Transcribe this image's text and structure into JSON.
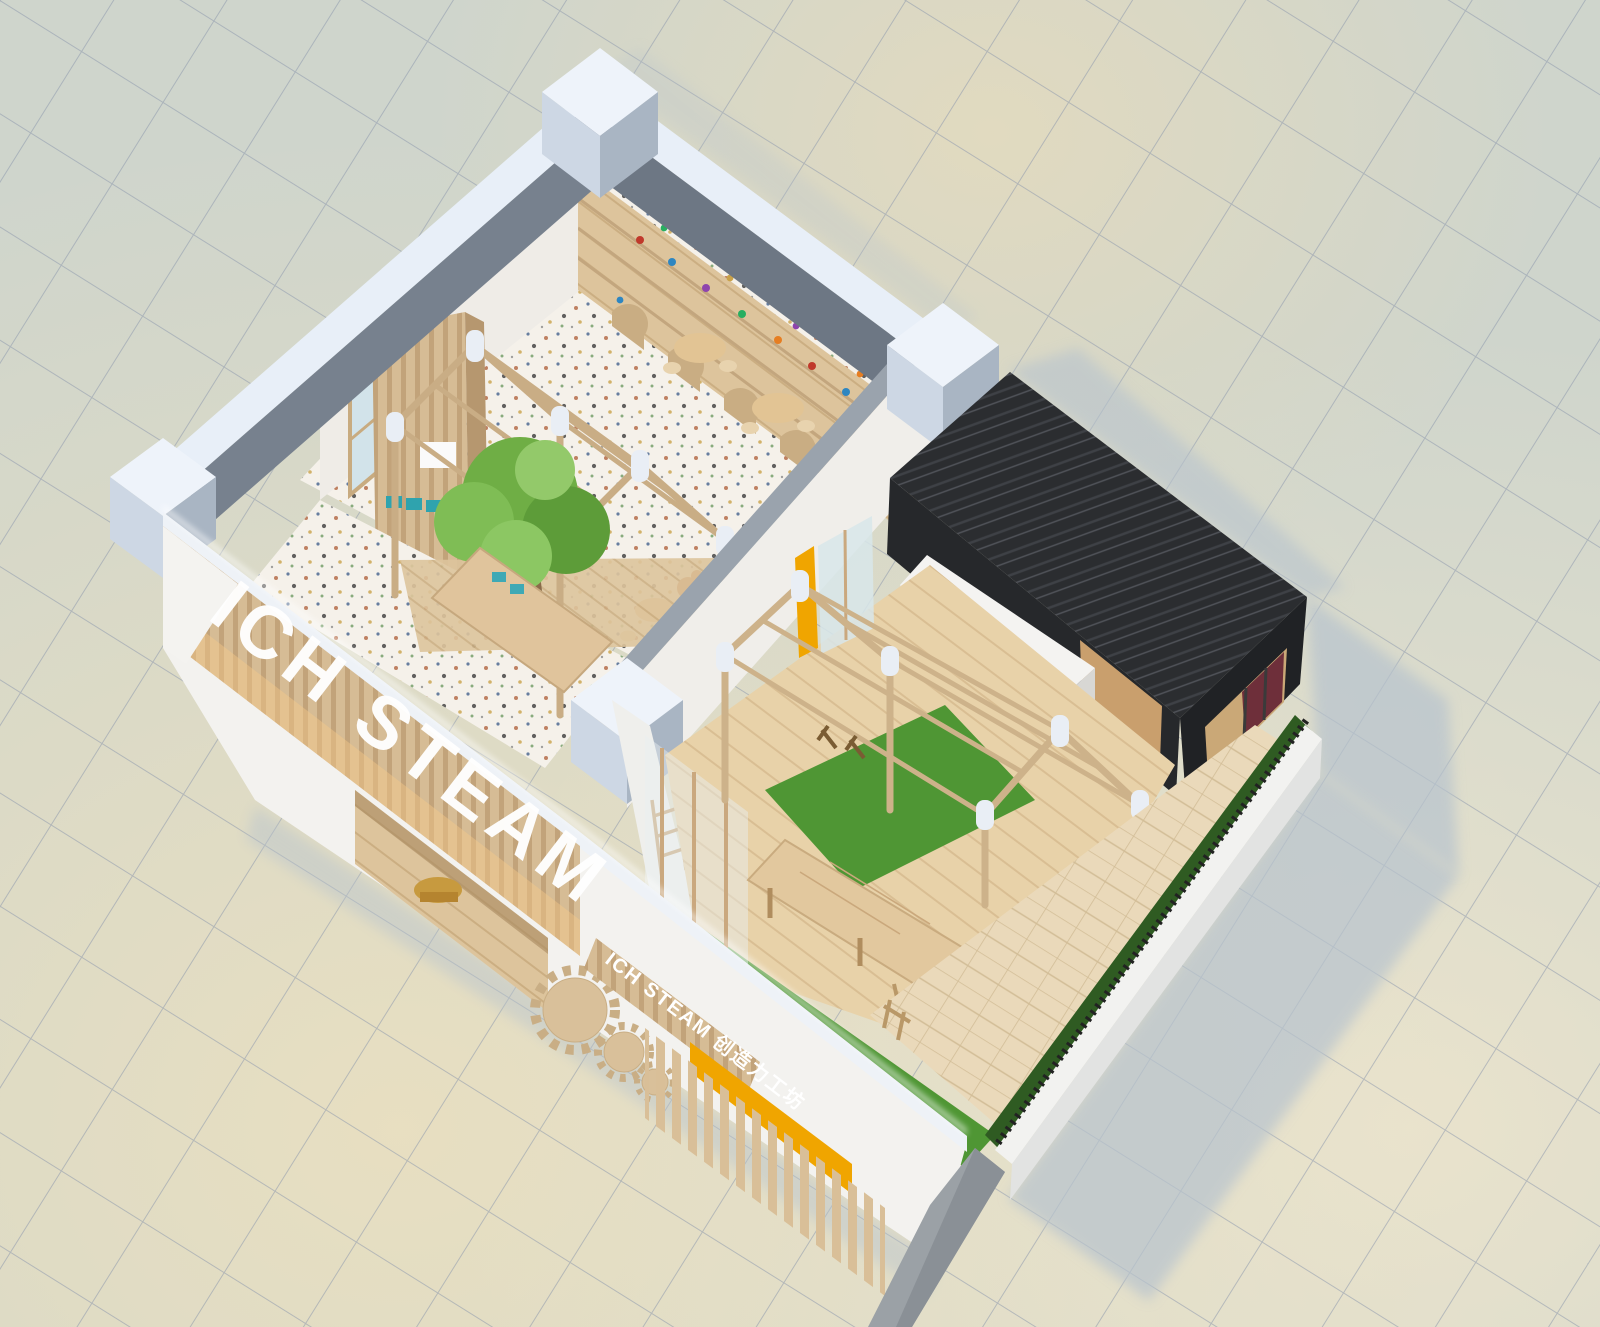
{
  "scene": {
    "kind": "axonometric-architectural-render",
    "subject": "children STEAM education center interior cutaway model",
    "view": "isometric top-down cutaway"
  },
  "branding": {
    "facade_letters": "ICH STEAM",
    "wall_sign_text": "ICH STEAM 创造力工坊",
    "logo_icon": "wood-gear-emblem"
  },
  "palette": {
    "ground_tile": "#cfd5cc",
    "ground_tile_warm": "#ecdfc0",
    "grid_line": "#8d99ad",
    "cast_shadow": "#b7c3ce",
    "wall_light": "#e8eff8",
    "wall_cut_gray": "#74808d",
    "pillar_light": "#eef3fa",
    "interior_white": "#f1efeb",
    "wood_light": "#d6bc95",
    "wood_mid": "#c2a37a",
    "wood_floor": "#e8d2a9",
    "terrazzo": "#f5f1ea",
    "tree_green": "#6fae45",
    "turf_green": "#4f9634",
    "hedge_green": "#2f5b22",
    "black_box": "#2b2d30",
    "accent_yellow": "#f0a500",
    "teal_bins": "#2fa3ae",
    "maroon_interior": "#6e2f3a"
  },
  "areas": {
    "shelf_room": "activity room with arched toy shelves",
    "atrium": "timber-frame atrium with tree",
    "workshop": "timber-frame wood workshop",
    "black_box": "charcoal timber box room",
    "entrance": "wood-lined entrance",
    "courtyard": "fenced courtyard with turf and pavers"
  }
}
